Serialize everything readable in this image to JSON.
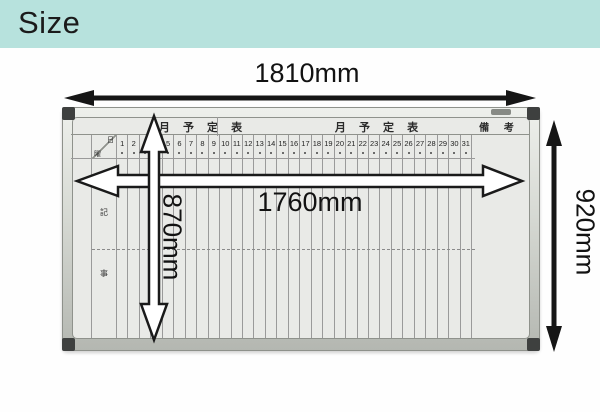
{
  "page": {
    "title": "Size"
  },
  "dimensions": {
    "outer_width": "1810mm",
    "inner_width": "1760mm",
    "inner_height": "870mm",
    "outer_height": "920mm"
  },
  "board": {
    "left_title": "月 予 定 表",
    "right_title": "月 予 定 表",
    "remarks_header": "備 考",
    "corner_day": "日",
    "corner_weekday": "曜",
    "row_label_top": "記",
    "row_label_bottom": "事",
    "dates": [
      "1",
      "2",
      "3",
      "4",
      "5",
      "6",
      "7",
      "8",
      "9",
      "10",
      "11",
      "12",
      "13",
      "14",
      "15",
      "16",
      "17",
      "18",
      "19",
      "20",
      "21",
      "22",
      "23",
      "24",
      "25",
      "26",
      "27",
      "28",
      "29",
      "30",
      "31"
    ]
  },
  "colors": {
    "banner": "#b7e2dd",
    "surface": "#e9eae7",
    "grid_line": "#9a9a9a",
    "arrow": "#161616",
    "cap": "#3e403f"
  }
}
